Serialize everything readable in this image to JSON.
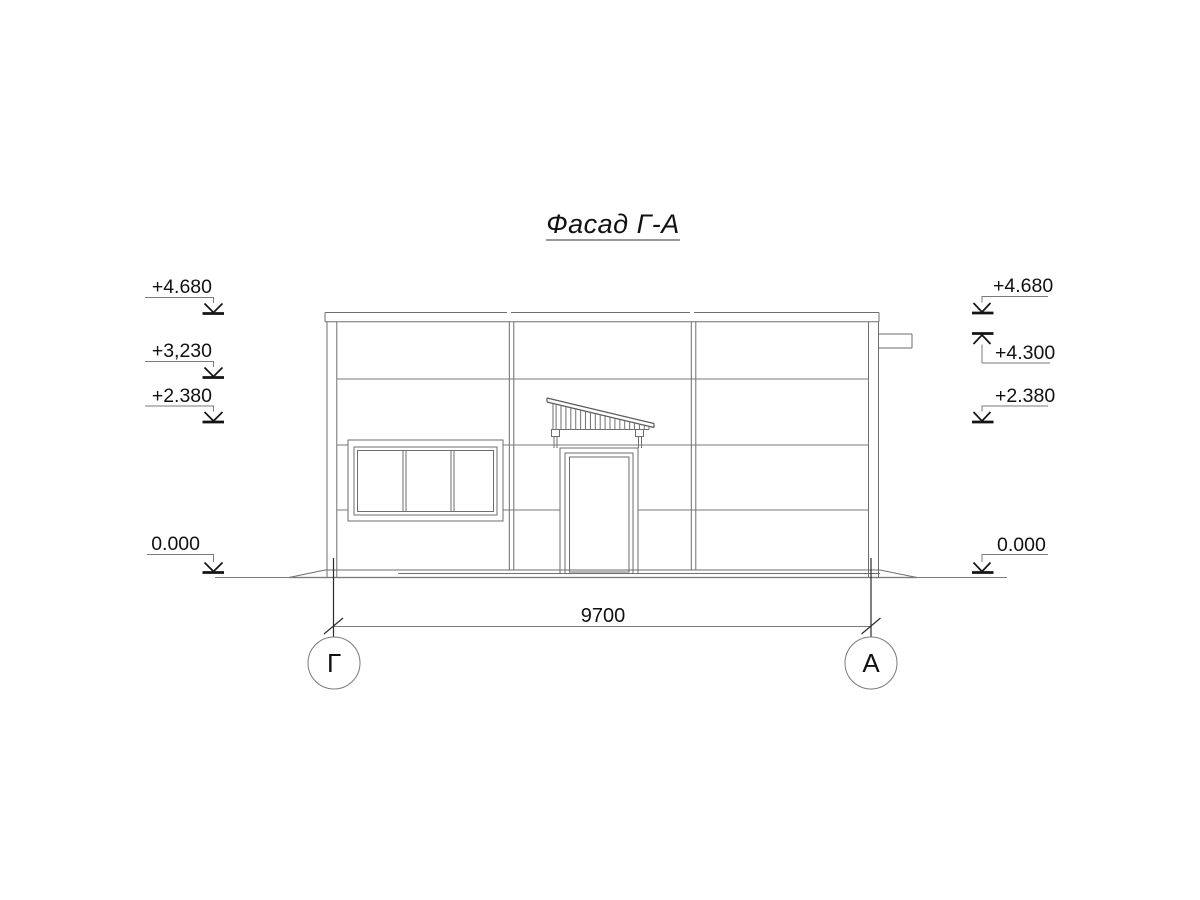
{
  "title": "Фасад Г-А",
  "marks_left": {
    "top": "+4.680",
    "mid": "+3,230",
    "low": "+2.380",
    "zero": "0.000"
  },
  "marks_right": {
    "top": "+4.680",
    "canopy": "+4.300",
    "low": "+2.380",
    "zero": "0.000"
  },
  "dimension_total": "9700",
  "axes": {
    "left": "Г",
    "right": "А"
  },
  "colors": {
    "background": "#ffffff",
    "line_gray": "#6e6e6e",
    "ink_black": "#141414"
  }
}
